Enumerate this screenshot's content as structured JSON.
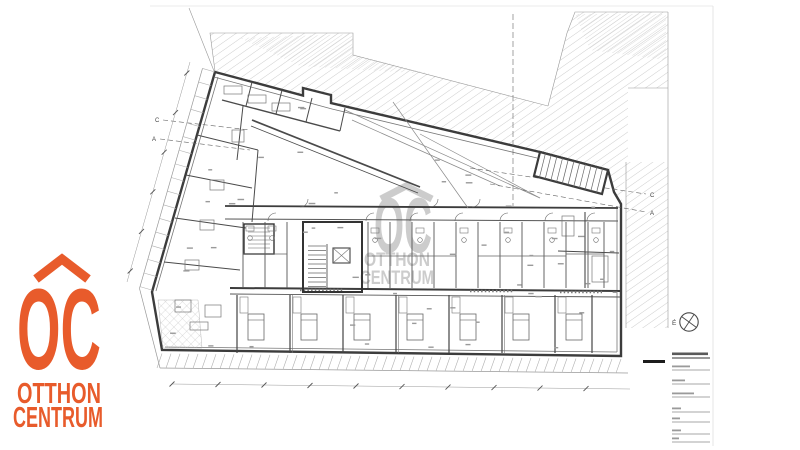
{
  "brand": {
    "monogram": "OC",
    "line1": "OTTHON",
    "line2": "CENTRUM",
    "color": "#E85B2B"
  },
  "watermark": {
    "monogram": "OC",
    "line1": "OTTHON",
    "line2": "CENTRUM",
    "color": "#9b9b9b"
  },
  "plan": {
    "north_label": "É",
    "grid_labels": {
      "left": [
        "C",
        "A"
      ],
      "right": [
        "C",
        "A"
      ]
    }
  },
  "title_block": {
    "title_bar_width": 36,
    "fields": [
      {
        "y": 370,
        "w": 18
      },
      {
        "y": 384,
        "w": 13
      },
      {
        "y": 397,
        "w": 22
      },
      {
        "y": 412,
        "w": 9
      },
      {
        "y": 422,
        "w": 8
      },
      {
        "y": 434,
        "w": 9
      },
      {
        "y": 442,
        "w": 7
      }
    ]
  },
  "colors": {
    "wall": "#3c3c3c",
    "mid": "#555555",
    "thin": "#999999",
    "hatch": "#c7c7c7",
    "accent": "#E85B2B"
  }
}
